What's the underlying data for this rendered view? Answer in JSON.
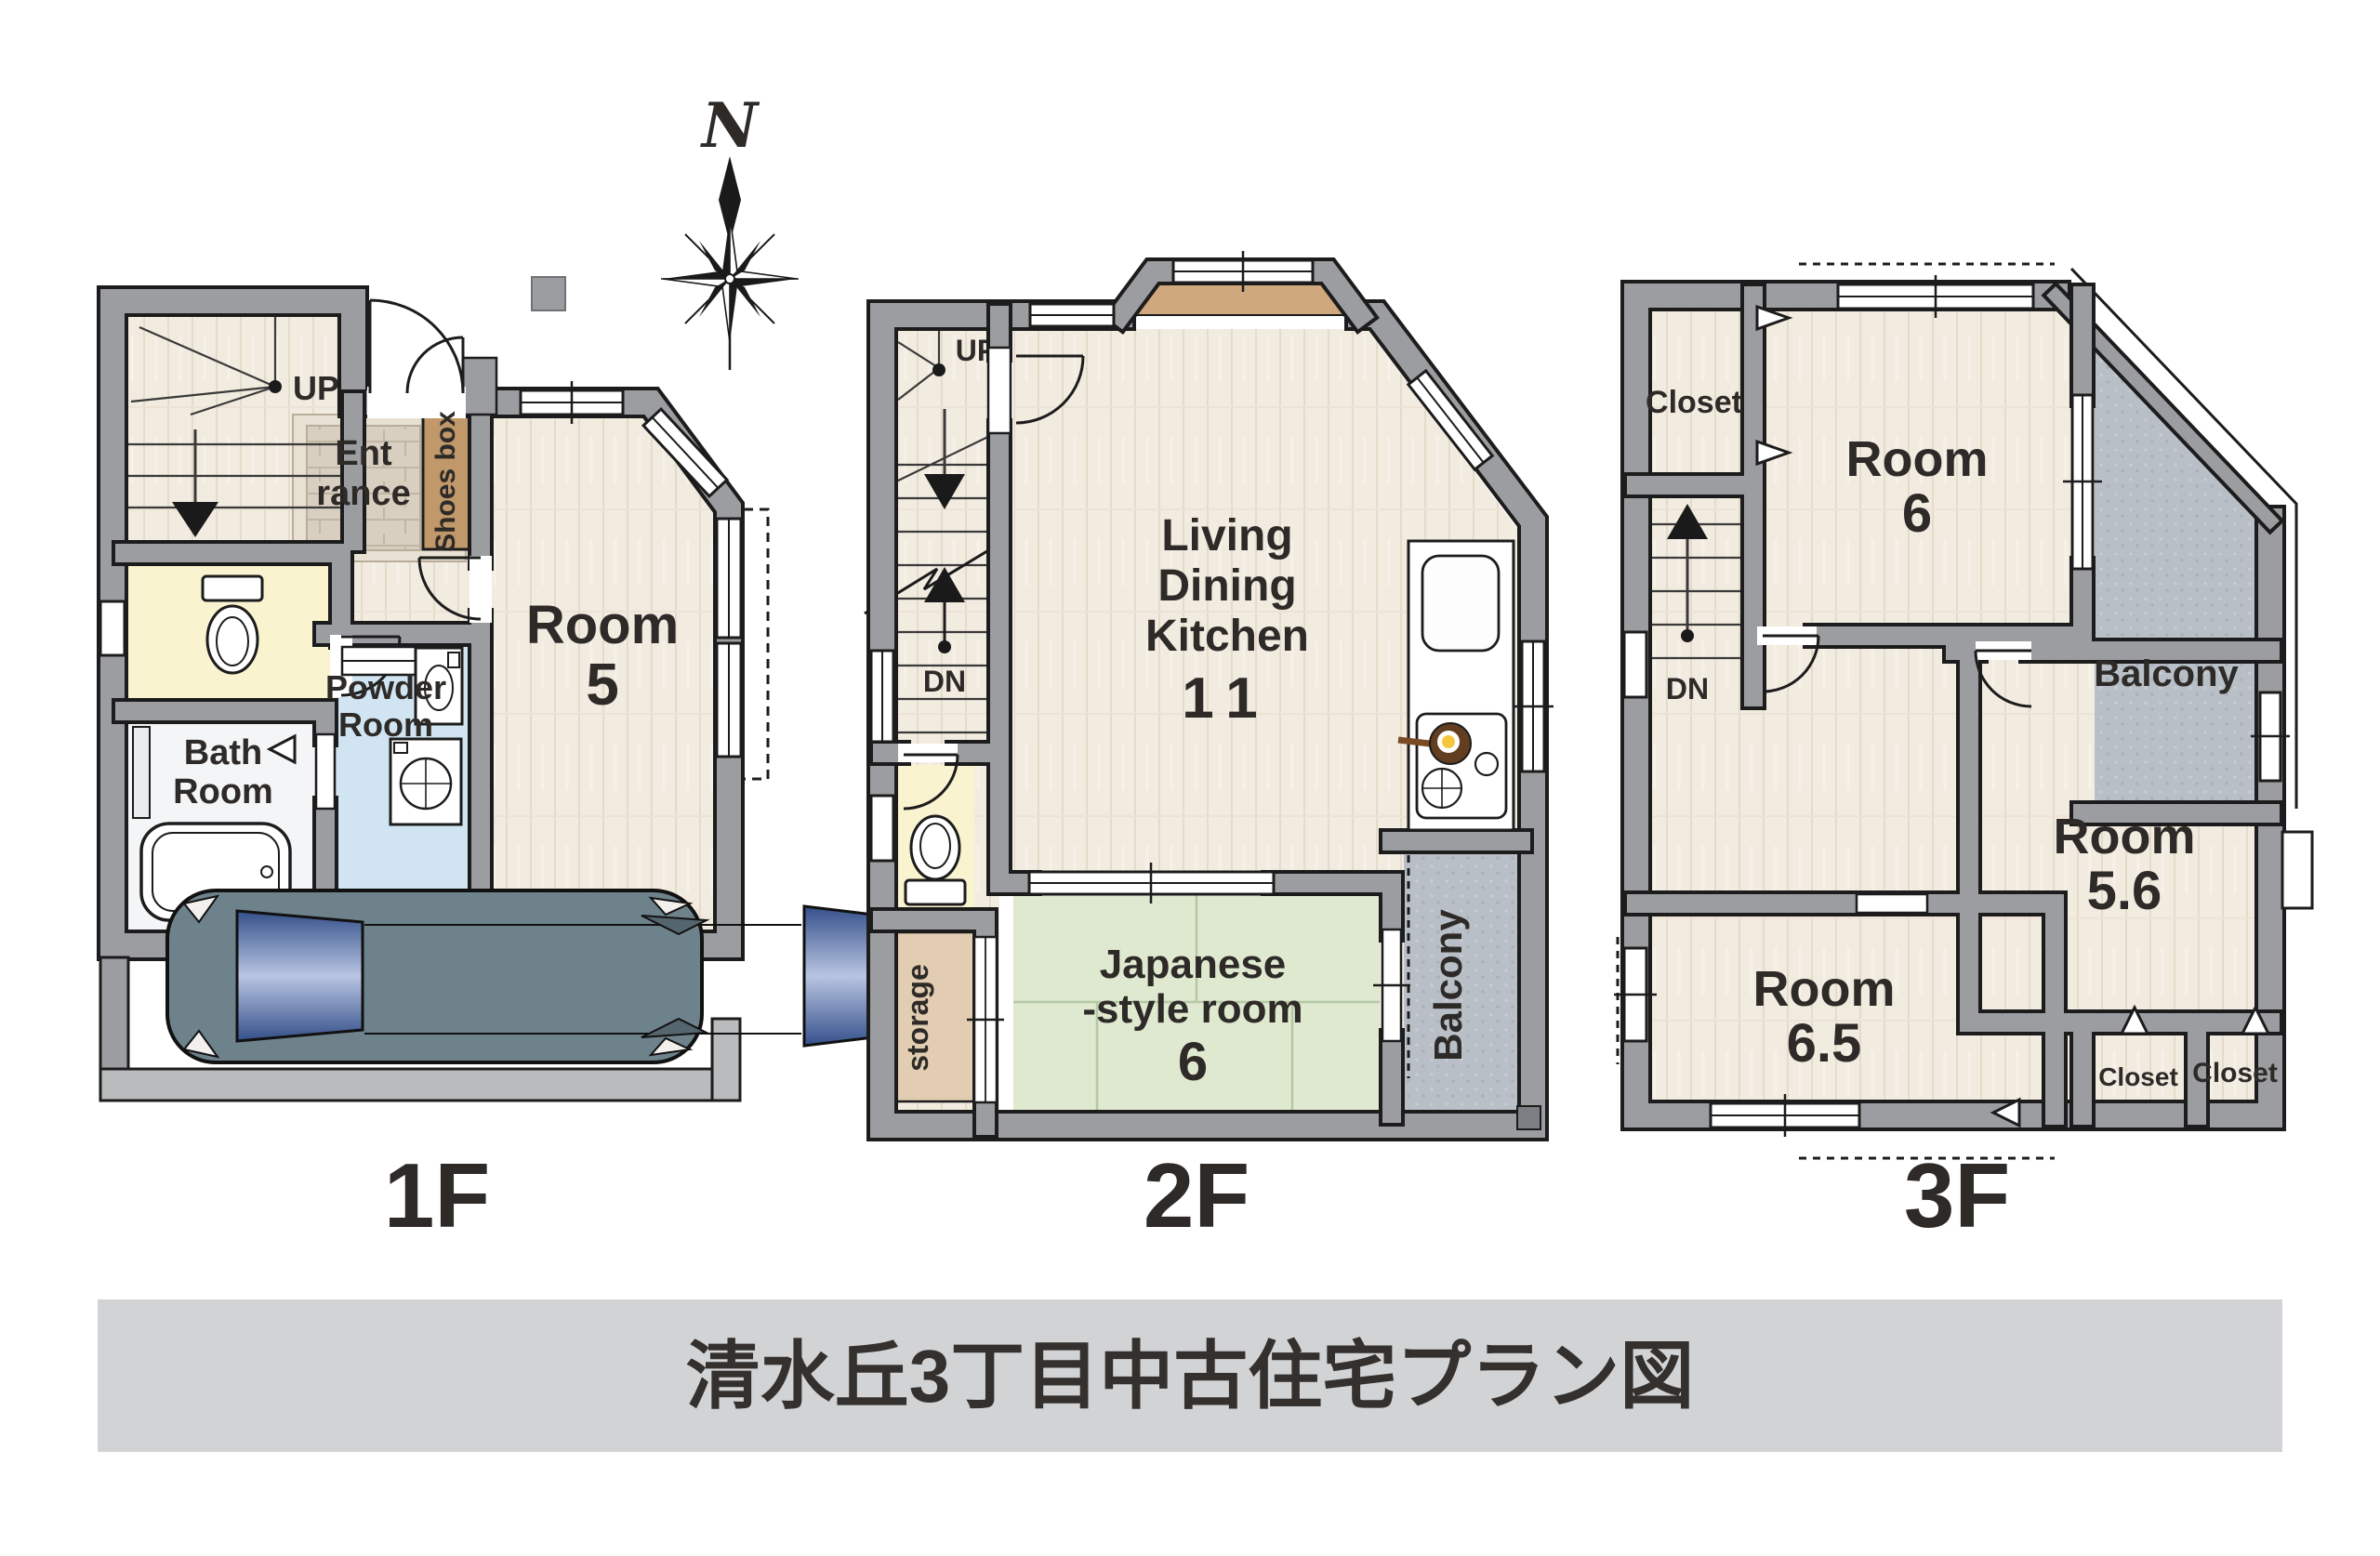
{
  "title": "清水丘3丁目中古住宅プラン図",
  "compass": {
    "north_label": "N"
  },
  "floor_1f": {
    "label": "1F",
    "stairs_up": "UP",
    "entrance_line1": "Ent",
    "entrance_line2": "rance",
    "shoes_box": "Shoes box",
    "room5_line1": "Room",
    "room5_line2": "5",
    "bath_line1": "Bath",
    "bath_line2": "Room",
    "powder_line1": "Powder",
    "powder_line2": "Room"
  },
  "floor_2f": {
    "label": "2F",
    "stairs_up": "UP",
    "stairs_down": "DN",
    "ldk_line1": "Living",
    "ldk_line2": "Dining",
    "ldk_line3": "Kitchen",
    "ldk_size": "11",
    "japanese_line1": "Japanese",
    "japanese_line2": "-style room",
    "japanese_size": "6",
    "storage": "storage",
    "balcony": "Balcony"
  },
  "floor_3f": {
    "label": "3F",
    "stairs_down": "DN",
    "closet_nw": "Closet",
    "room6_line1": "Room",
    "room6_line2": "6",
    "balcony": "Balcony",
    "room56_line1": "Room",
    "room56_line2": "5.6",
    "room65_line1": "Room",
    "room65_line2": "6.5",
    "closet_s_left": "Closet",
    "closet_s_right": "Closet"
  },
  "colors": {
    "wall": "#9b9da0",
    "wall_outline": "#1c1c1c",
    "wood_floor": "#f2ebe0",
    "entrance_tile": "#d8cfc1",
    "tatami": "#dfe9d0",
    "toilet_room": "#faf3cf",
    "powder_room": "#d0e4f2",
    "bath_room": "#f4f5f6",
    "shoes_box": "#c0986a",
    "storage": "#e2cdb2",
    "balcony": "#b9bfc6",
    "car_body": "#6e828b",
    "title_bar_bg": "#d2d3d5",
    "text": "#2d2a28"
  }
}
